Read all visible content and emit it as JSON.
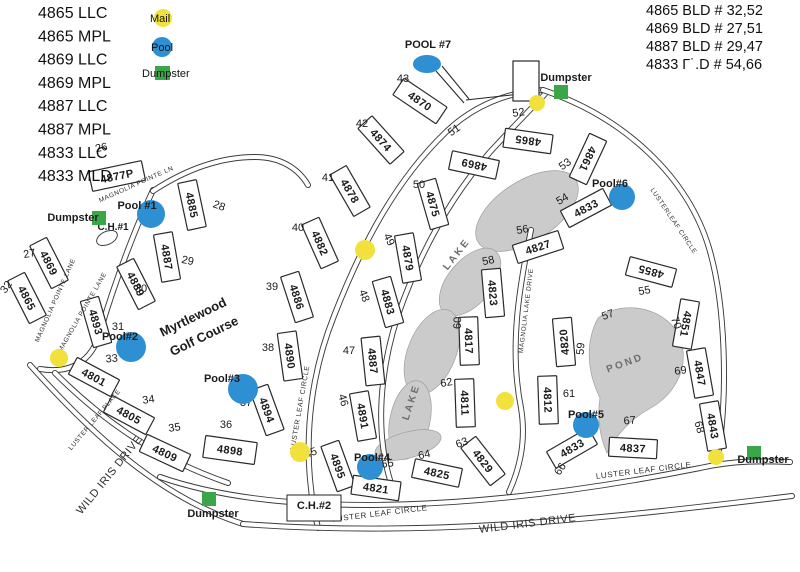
{
  "legend_left": {
    "lines": [
      "4865 LLC",
      "4865 MPL",
      "4869 LLC",
      "4869 MPL",
      "4887 LLC",
      "4887 MPL",
      "4833 LLC",
      "4833 MLD"
    ]
  },
  "legend_right": {
    "lines": [
      "4865 BLD # 32,52",
      "4869 BLD # 27,51",
      "4887 BLD # 29,47",
      "4833 Γ˙.D # 54,66"
    ]
  },
  "legend_key": {
    "mail": "Mail",
    "pool": "Pool",
    "dumpster": "Dumpster"
  },
  "colors": {
    "mail": "#F2E13C",
    "pool": "#2E8FD2",
    "dumpster": "#3BA648",
    "water": "#CBCBCB",
    "ink": "#1B1B1B"
  },
  "map": {
    "title_lines": [
      {
        "t": "Myrtlewood",
        "x": 195,
        "y": 321,
        "r": -26,
        "s": 13
      },
      {
        "t": "Golf Course",
        "x": 206,
        "y": 340,
        "r": -26,
        "s": 13
      }
    ],
    "buildings": [
      {
        "t": "4877P",
        "x": 117,
        "y": 176,
        "r": -12,
        "w": 54,
        "h": 20
      },
      {
        "t": "4885",
        "x": 192,
        "y": 205,
        "r": 78
      },
      {
        "t": "4869",
        "x": 49,
        "y": 263,
        "r": 63
      },
      {
        "t": "4887",
        "x": 167,
        "y": 257,
        "r": 80
      },
      {
        "t": "4889",
        "x": 136,
        "y": 284,
        "r": 63
      },
      {
        "t": "4865",
        "x": 27,
        "y": 298,
        "r": 63
      },
      {
        "t": "4893",
        "x": 96,
        "y": 322,
        "r": 74
      },
      {
        "t": "4801",
        "x": 94,
        "y": 377,
        "r": 28
      },
      {
        "t": "4805",
        "x": 129,
        "y": 415,
        "r": 28
      },
      {
        "t": "4809",
        "x": 165,
        "y": 453,
        "r": 25
      },
      {
        "t": "4898",
        "x": 230,
        "y": 450,
        "r": 8,
        "w": 52,
        "h": 22
      },
      {
        "t": "4894",
        "x": 267,
        "y": 410,
        "r": 70
      },
      {
        "t": "4890",
        "x": 290,
        "y": 356,
        "r": 82
      },
      {
        "t": "4886",
        "x": 297,
        "y": 297,
        "r": 72
      },
      {
        "t": "4882",
        "x": 320,
        "y": 243,
        "r": 66
      },
      {
        "t": "4878",
        "x": 350,
        "y": 191,
        "r": 60
      },
      {
        "t": "4874",
        "x": 381,
        "y": 140,
        "r": 48
      },
      {
        "t": "4870",
        "x": 420,
        "y": 101,
        "r": 34,
        "w": 52,
        "h": 20
      },
      {
        "t": "4895",
        "x": 338,
        "y": 466,
        "r": 70
      },
      {
        "t": "4891",
        "x": 363,
        "y": 416,
        "r": 80
      },
      {
        "t": "4887",
        "x": 373,
        "y": 361,
        "r": 84
      },
      {
        "t": "4883",
        "x": 388,
        "y": 302,
        "r": 74
      },
      {
        "t": "4879",
        "x": 408,
        "y": 258,
        "r": 80
      },
      {
        "t": "4875",
        "x": 433,
        "y": 204,
        "r": 74
      },
      {
        "t": "4869",
        "x": 474,
        "y": 165,
        "r": -168
      },
      {
        "t": "4865",
        "x": 528,
        "y": 141,
        "r": -172
      },
      {
        "t": "4861",
        "x": 588,
        "y": 159,
        "r": 115
      },
      {
        "t": "4833",
        "x": 586,
        "y": 208,
        "r": -28
      },
      {
        "t": "4827",
        "x": 538,
        "y": 247,
        "r": -18
      },
      {
        "t": "4823",
        "x": 493,
        "y": 293,
        "r": 85
      },
      {
        "t": "4817",
        "x": 469,
        "y": 341,
        "r": 88
      },
      {
        "t": "4811",
        "x": 465,
        "y": 403,
        "r": 88
      },
      {
        "t": "4812",
        "x": 548,
        "y": 400,
        "r": 88
      },
      {
        "t": "4820",
        "x": 564,
        "y": 342,
        "r": -95
      },
      {
        "t": "4855",
        "x": 651,
        "y": 272,
        "r": -165
      },
      {
        "t": "4851",
        "x": 686,
        "y": 324,
        "r": 100
      },
      {
        "t": "4829",
        "x": 483,
        "y": 461,
        "r": 52
      },
      {
        "t": "4825",
        "x": 437,
        "y": 473,
        "r": 12
      },
      {
        "t": "4821",
        "x": 376,
        "y": 488,
        "r": 8
      },
      {
        "t": "4833",
        "x": 572,
        "y": 448,
        "r": -30
      },
      {
        "t": "4837",
        "x": 633,
        "y": 448,
        "r": 3
      },
      {
        "t": "4843",
        "x": 713,
        "y": 426,
        "r": 80
      },
      {
        "t": "4847",
        "x": 700,
        "y": 373,
        "r": 80
      }
    ],
    "numbers": [
      {
        "t": "26",
        "x": 102,
        "y": 151,
        "r": -12
      },
      {
        "t": "27",
        "x": 30,
        "y": 257,
        "r": -10
      },
      {
        "t": "28",
        "x": 218,
        "y": 209,
        "r": 20
      },
      {
        "t": "29",
        "x": 187,
        "y": 264,
        "r": 12
      },
      {
        "t": "30",
        "x": 141,
        "y": 292,
        "r": 0
      },
      {
        "t": "31",
        "x": 118,
        "y": 330,
        "r": 0
      },
      {
        "t": "32",
        "x": 9,
        "y": 289,
        "r": -55
      },
      {
        "t": "33",
        "x": 112,
        "y": 362,
        "r": -5
      },
      {
        "t": "34",
        "x": 149,
        "y": 403,
        "r": -8
      },
      {
        "t": "35",
        "x": 175,
        "y": 431,
        "r": -8
      },
      {
        "t": "36",
        "x": 226,
        "y": 428,
        "r": 0
      },
      {
        "t": "37",
        "x": 246,
        "y": 406,
        "r": 0
      },
      {
        "t": "38",
        "x": 268,
        "y": 351,
        "r": 0
      },
      {
        "t": "39",
        "x": 272,
        "y": 290,
        "r": 0
      },
      {
        "t": "40",
        "x": 298,
        "y": 231,
        "r": 0
      },
      {
        "t": "41",
        "x": 328,
        "y": 181,
        "r": 0
      },
      {
        "t": "42",
        "x": 362,
        "y": 127,
        "r": 0
      },
      {
        "t": "43",
        "x": 403,
        "y": 82,
        "r": 0
      },
      {
        "t": "45",
        "x": 312,
        "y": 456,
        "r": -20
      },
      {
        "t": "46",
        "x": 340,
        "y": 401,
        "r": 75
      },
      {
        "t": "47",
        "x": 349,
        "y": 354,
        "r": 0
      },
      {
        "t": "48",
        "x": 361,
        "y": 297,
        "r": 70
      },
      {
        "t": "49",
        "x": 386,
        "y": 241,
        "r": 65
      },
      {
        "t": "50",
        "x": 419,
        "y": 188,
        "r": 0
      },
      {
        "t": "51",
        "x": 456,
        "y": 133,
        "r": -35
      },
      {
        "t": "52",
        "x": 519,
        "y": 116,
        "r": -8
      },
      {
        "t": "53",
        "x": 567,
        "y": 167,
        "r": -35
      },
      {
        "t": "54",
        "x": 564,
        "y": 202,
        "r": -30
      },
      {
        "t": "55",
        "x": 645,
        "y": 294,
        "r": -10
      },
      {
        "t": "56",
        "x": 523,
        "y": 233,
        "r": -10
      },
      {
        "t": "57",
        "x": 609,
        "y": 318,
        "r": -20
      },
      {
        "t": "58",
        "x": 489,
        "y": 264,
        "r": -12
      },
      {
        "t": "59",
        "x": 584,
        "y": 349,
        "r": -85
      },
      {
        "t": "60",
        "x": 461,
        "y": 323,
        "r": -88
      },
      {
        "t": "61",
        "x": 569,
        "y": 397,
        "r": 0
      },
      {
        "t": "62",
        "x": 447,
        "y": 386,
        "r": -10
      },
      {
        "t": "63",
        "x": 463,
        "y": 446,
        "r": -20
      },
      {
        "t": "64",
        "x": 425,
        "y": 458,
        "r": -12
      },
      {
        "t": "65",
        "x": 388,
        "y": 467,
        "r": -8
      },
      {
        "t": "66",
        "x": 563,
        "y": 471,
        "r": -55
      },
      {
        "t": "67",
        "x": 630,
        "y": 424,
        "r": -5
      },
      {
        "t": "68",
        "x": 696,
        "y": 428,
        "r": 75
      },
      {
        "t": "69",
        "x": 681,
        "y": 374,
        "r": -8
      },
      {
        "t": "70",
        "x": 673,
        "y": 324,
        "r": 70
      }
    ],
    "streets": [
      {
        "t": "MAGNOLIA POINTE LN",
        "x": 137,
        "y": 186,
        "r": -24,
        "s": 6.5
      },
      {
        "t": "MAGNOLIA POINTE LANE",
        "x": 57,
        "y": 301,
        "r": -66,
        "s": 6.5
      },
      {
        "t": "MAGNOLIA POINTE LANE",
        "x": 84,
        "y": 313,
        "r": -60,
        "s": 6.5
      },
      {
        "t": "LUSTER LEAF PLACE",
        "x": 96,
        "y": 421,
        "r": -50,
        "s": 6.5
      },
      {
        "t": "LUSTER LEAF CIRCLE",
        "x": 302,
        "y": 408,
        "r": -80,
        "s": 7
      },
      {
        "t": "LUSTER LEAF CIRCLE",
        "x": 380,
        "y": 516,
        "r": -7,
        "s": 8
      },
      {
        "t": "LUSTER LEAF CIRCLE",
        "x": 644,
        "y": 473,
        "r": -7,
        "s": 8
      },
      {
        "t": "LUSTERLEAF CIRCLE",
        "x": 672,
        "y": 222,
        "r": 56,
        "s": 6.5
      },
      {
        "t": "MAGNOLIA LAKE DRIVE",
        "x": 528,
        "y": 311,
        "r": -83,
        "s": 6.5
      },
      {
        "t": "WILD IRIS DRIVE",
        "x": 112,
        "y": 477,
        "r": -51,
        "s": 11
      },
      {
        "t": "WILD IRIS DRIVE",
        "x": 528,
        "y": 527,
        "r": -7,
        "s": 11
      }
    ],
    "areas": [
      {
        "t": "LAKE",
        "x": 459,
        "y": 256,
        "r": -52
      },
      {
        "t": "LAKE",
        "x": 414,
        "y": 403,
        "r": -72
      },
      {
        "t": "POND",
        "x": 626,
        "y": 366,
        "r": -20
      }
    ],
    "misc": [
      {
        "t": "C.H.#1",
        "x": 113,
        "y": 230,
        "s": 10
      },
      {
        "t": "C.H.#2",
        "x": 314,
        "y": 509,
        "s": 11,
        "boxed": true,
        "bx": 287,
        "by": 495,
        "bw": 54,
        "bh": 26
      },
      {
        "t": "POOL #7",
        "x": 428,
        "y": 48,
        "s": 11,
        "b": true
      }
    ],
    "pools": [
      {
        "t": "Pool #1",
        "cx": 151,
        "cy": 214,
        "rx": 14,
        "ry": 14,
        "lx": 137,
        "ly": 209
      },
      {
        "t": "Pool#2",
        "cx": 131,
        "cy": 347,
        "rx": 15,
        "ry": 15,
        "lx": 120,
        "ly": 340
      },
      {
        "t": "Pool#3",
        "cx": 243,
        "cy": 389,
        "rx": 15,
        "ry": 15,
        "lx": 222,
        "ly": 382
      },
      {
        "t": "Pool#4",
        "cx": 370,
        "cy": 467,
        "rx": 13,
        "ry": 13,
        "lx": 372,
        "ly": 461
      },
      {
        "t": "Pool#5",
        "cx": 586,
        "cy": 425,
        "rx": 13,
        "ry": 13,
        "lx": 586,
        "ly": 418
      },
      {
        "t": "Pool#6",
        "cx": 622,
        "cy": 197,
        "rx": 13,
        "ry": 13,
        "lx": 610,
        "ly": 187
      },
      {
        "t": "",
        "cx": 427,
        "cy": 64,
        "rx": 14,
        "ry": 9,
        "lx": 0,
        "ly": 0
      }
    ],
    "dumpsters": [
      {
        "t": "Dumpster",
        "x": 561,
        "y": 92,
        "lx": 566,
        "ly": 81
      },
      {
        "t": "Dumpster",
        "x": 99,
        "y": 218,
        "lx": 73,
        "ly": 221
      },
      {
        "t": "Dumpster",
        "x": 209,
        "y": 499,
        "lx": 213,
        "ly": 517
      },
      {
        "t": "Dumpster",
        "x": 754,
        "y": 453,
        "lx": 763,
        "ly": 463
      }
    ],
    "mails": [
      {
        "x": 537,
        "y": 103,
        "r": 8
      },
      {
        "x": 365,
        "y": 250,
        "r": 10
      },
      {
        "x": 59,
        "y": 358,
        "r": 9
      },
      {
        "x": 300,
        "y": 452,
        "r": 10
      },
      {
        "x": 505,
        "y": 401,
        "r": 9
      },
      {
        "x": 716,
        "y": 457,
        "r": 8
      }
    ]
  }
}
